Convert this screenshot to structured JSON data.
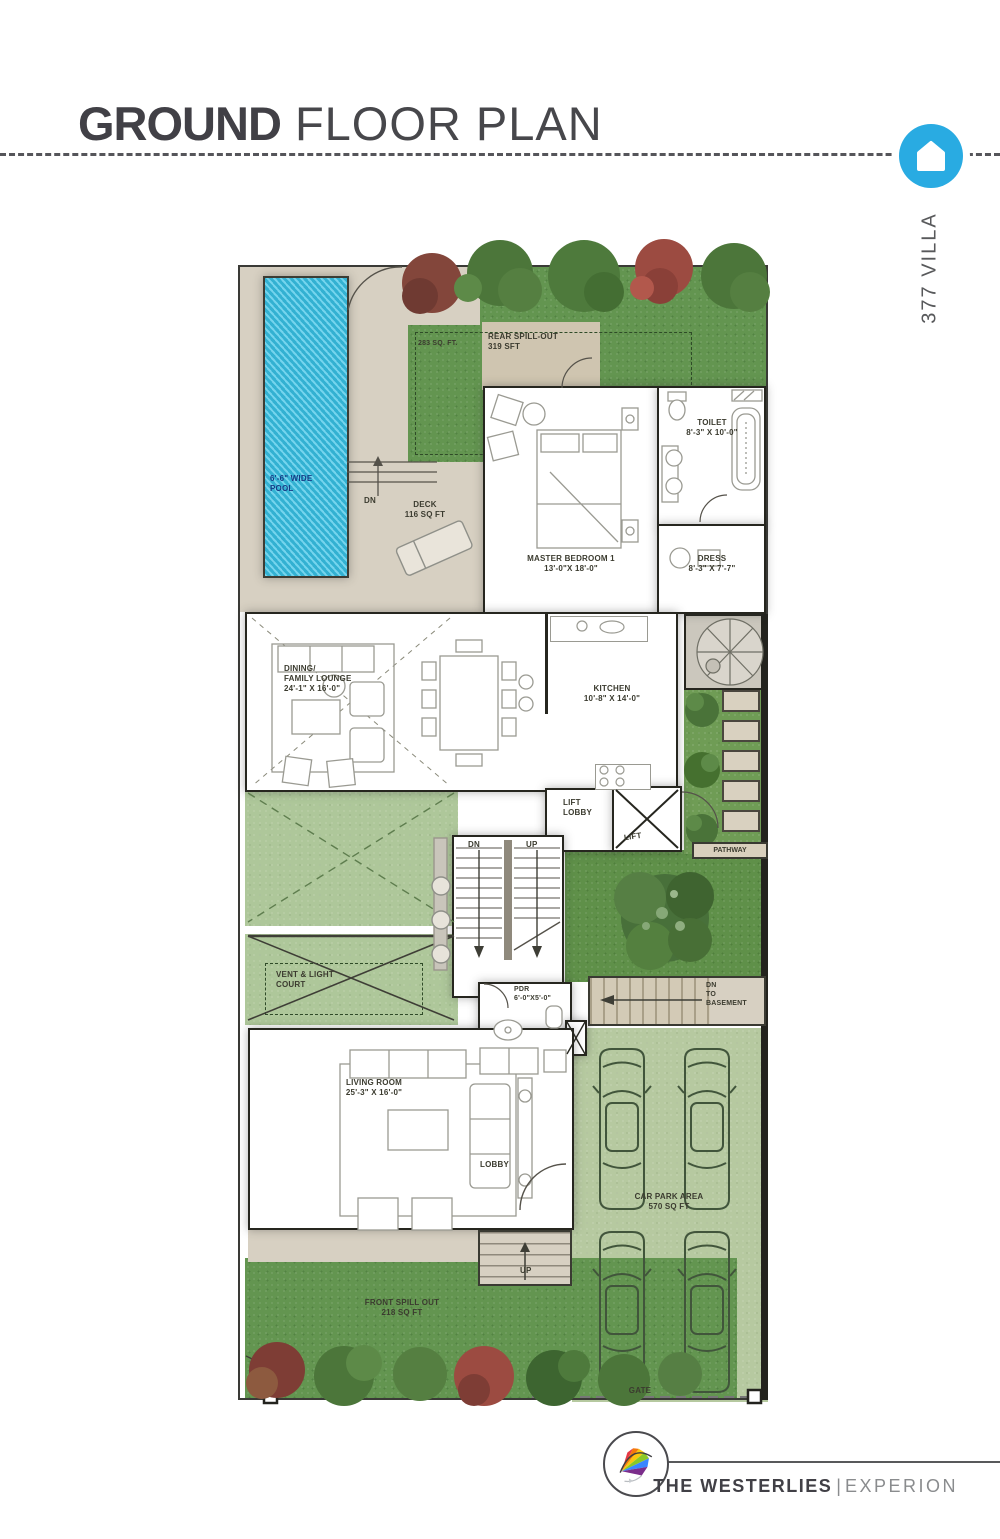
{
  "header": {
    "title_bold": "GROUND",
    "title_light": " FLOOR PLAN",
    "villa_label": "377 VILLA",
    "accent_color": "#29abe2"
  },
  "plan": {
    "areas": {
      "pool": {
        "line1": "6'-6\" WIDE",
        "line2": "POOL"
      },
      "pool_steps_dn": "DN",
      "deck": {
        "name": "DECK",
        "area": "116 SQ FT"
      },
      "rear_lawn_area": "283 SQ. FT.",
      "rear_spill": {
        "name": "REAR SPILL-OUT",
        "area": "319 SFT"
      },
      "master_bedroom": {
        "name": "MASTER BEDROOM 1",
        "dims": "13'-0\"X 18'-0\""
      },
      "toilet": {
        "name": "TOILET",
        "dims": "8'-3\" X 10'-0\""
      },
      "dress": {
        "name": "DRESS",
        "dims": "8'-3\" X 7'-7\""
      },
      "kitchen": {
        "name": "KITCHEN",
        "dims": "10'-8\" X 14'-0\""
      },
      "dining": {
        "line1": "DINING/",
        "line2": "FAMILY LOUNGE",
        "dims": "24'-1\" X 16'-0\""
      },
      "lift_lobby": {
        "line1": "LIFT",
        "line2": "LOBBY"
      },
      "lift": "LIFT",
      "pathway": "PATHWAY",
      "stairs": {
        "dn": "DN",
        "up": "UP"
      },
      "vent_court": {
        "line1": "VENT & LIGHT",
        "line2": "COURT"
      },
      "pdr": {
        "name": "PDR",
        "dims": "6'-0\"X5'-0\""
      },
      "ramp": {
        "line1": "DN",
        "line2": "TO",
        "line3": "BASEMENT"
      },
      "living": {
        "name": "LIVING ROOM",
        "dims": "25'-3\" X 16'-0\""
      },
      "lobby": "LOBBY",
      "entrance_up": "UP",
      "car_park": {
        "name": "CAR PARK AREA",
        "area": "570 SQ FT"
      },
      "gate": "GATE",
      "front_spill": {
        "name": "FRONT SPILL OUT",
        "area": "218 SQ FT"
      }
    }
  },
  "footer": {
    "brand": "THE WESTERLIES",
    "separator": "|",
    "developer": "EXPERION"
  }
}
